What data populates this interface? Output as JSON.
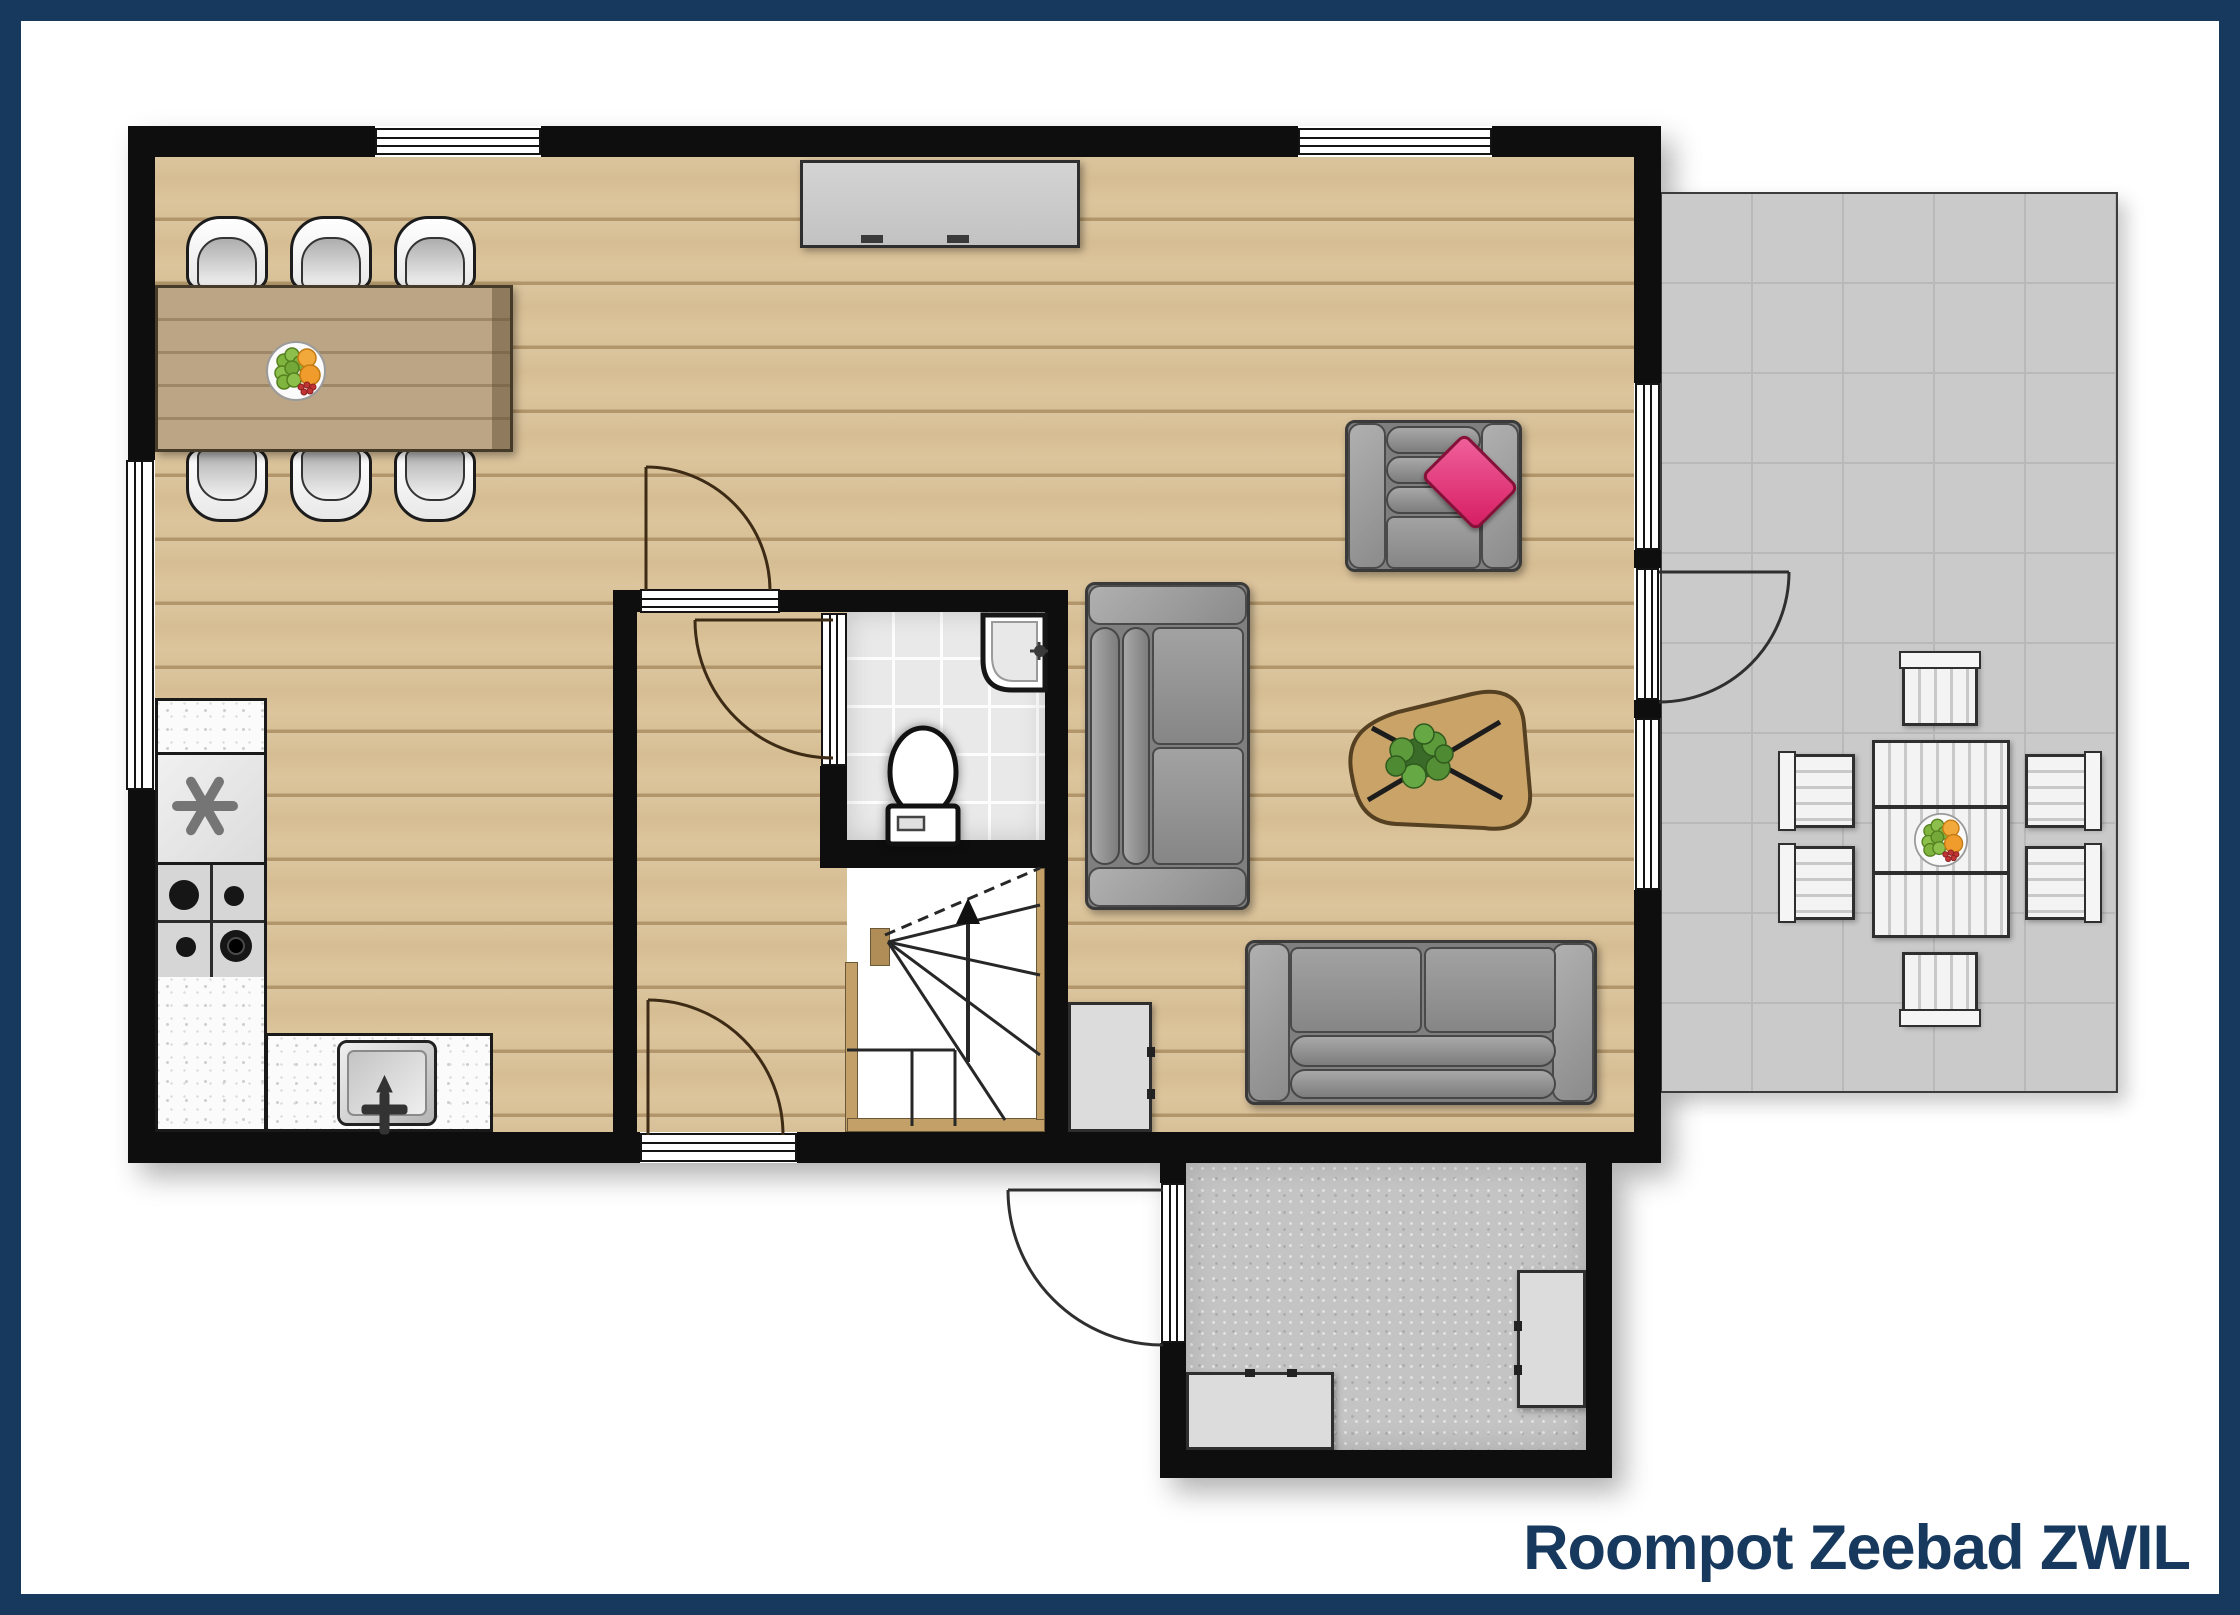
{
  "title": "Roompot Zeebad ZWIL",
  "colors": {
    "frame_navy": "#17395e",
    "wall_black": "#0e0e0e",
    "wood_floor": "#d9c096",
    "terrace_gray": "#cacaca",
    "hall_tile_gray": "#c4c4c4",
    "bath_tile": "#e9e9e9",
    "sofa_gray": "#8a8a8a",
    "pillow_pink": "#d61d62",
    "table_wood": "#b49b77",
    "plant_green": "#5c9a3b"
  },
  "rooms": [
    {
      "name": "living-dining-area",
      "floor": "wood"
    },
    {
      "name": "kitchen",
      "floor": "wood"
    },
    {
      "name": "hallway",
      "floor": "wood"
    },
    {
      "name": "bathroom",
      "floor": "white-tile"
    },
    {
      "name": "staircase",
      "floor": "white"
    },
    {
      "name": "entrance-hall",
      "floor": "gray-tile"
    },
    {
      "name": "terrace",
      "floor": "gray-tile-grid"
    }
  ],
  "furniture": {
    "dining": [
      "dining-table",
      "fruit-bowl",
      "chair x6"
    ],
    "kitchen": [
      "counter",
      "fridge-freezer",
      "gas-hob-4-burners",
      "kitchen-sink"
    ],
    "living": [
      "tv-sideboard",
      "armchair-with-pink-pillow",
      "two-seat-sofa",
      "three-seat-sofa",
      "coffee-table-with-plant",
      "cabinet"
    ],
    "bathroom": [
      "washbasin",
      "toilet"
    ],
    "entrance-hall": [
      "cabinet-low",
      "cabinet-side"
    ],
    "terrace": [
      "outdoor-table",
      "fruit-bowl",
      "outdoor-chair x6"
    ]
  },
  "doors": [
    "hallway-door",
    "bathroom-door",
    "back-door",
    "terrace-door",
    "front-door"
  ],
  "windows": [
    "top-dining-window",
    "top-living-window",
    "left-dining-window",
    "right-upper-window",
    "right-lower-window"
  ],
  "stairs": {
    "direction_arrow": "up"
  }
}
